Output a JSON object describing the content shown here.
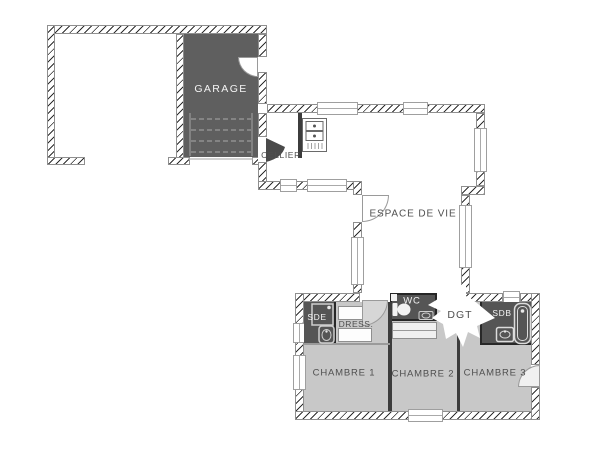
{
  "plan_title": "Plan de maison - rez-de-chaussée",
  "colors": {
    "wall-line": "#2e2e2e",
    "wall-edge": "#8f8f8f",
    "garage-fill": "#5f5f5f",
    "wetroom-fill": "#555555",
    "bedroom-fill": "#c8c8c8",
    "partition": "#3c3c3c",
    "label-dark": "#4f4f4f",
    "label-light": "#f4f4f4"
  },
  "rooms": {
    "garage": {
      "label": "GARAGE"
    },
    "cellier": {
      "label": "CELLIER"
    },
    "espace_de_vie": {
      "label": "ESPACE DE VIE"
    },
    "sde": {
      "label": "SDE"
    },
    "dressing": {
      "label": "DRESS."
    },
    "wc": {
      "label": "WC"
    },
    "dgt": {
      "label": "DGT"
    },
    "sdb": {
      "label": "SDB"
    },
    "chambre1": {
      "label": "CHAMBRE 1"
    },
    "chambre2": {
      "label": "CHAMBRE 2"
    },
    "chambre3": {
      "label": "CHAMBRE 3"
    }
  }
}
